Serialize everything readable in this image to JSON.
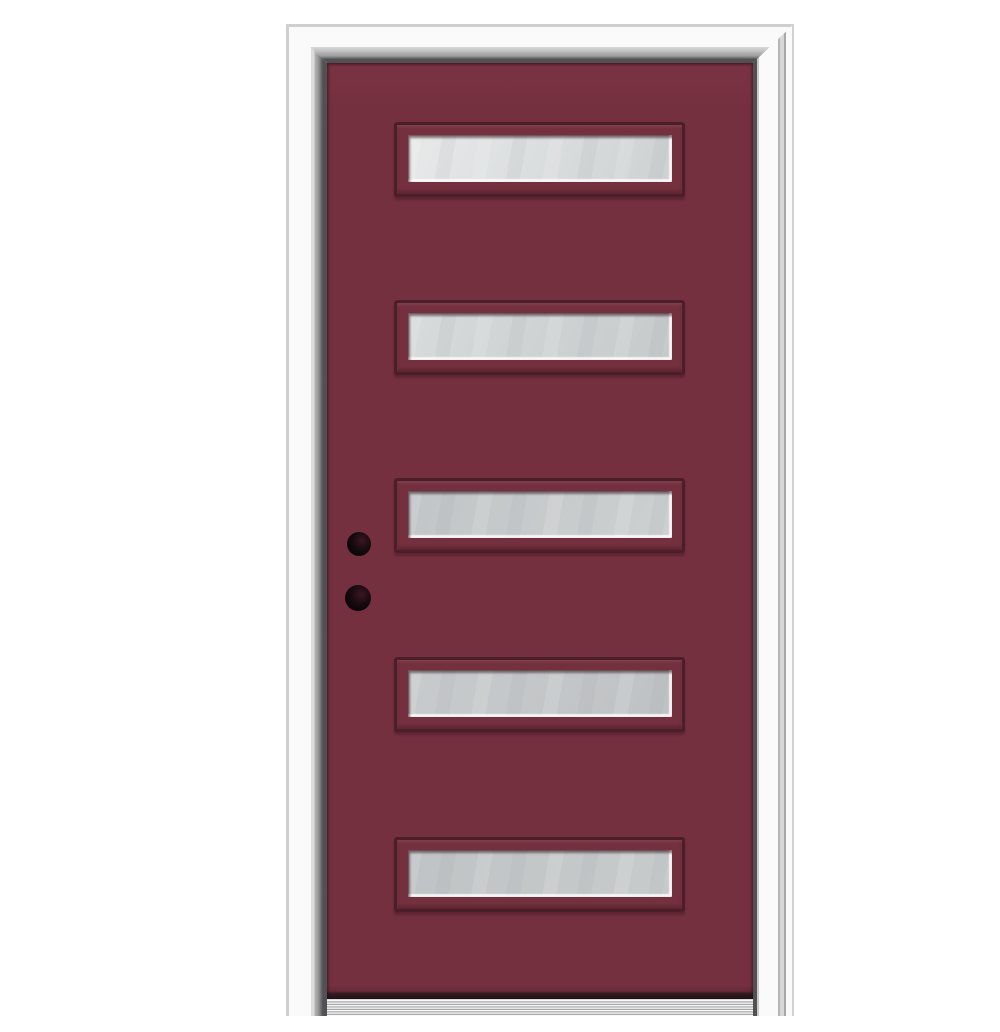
{
  "image": {
    "type": "product-photo",
    "subject": "Burgundy painted front entry door, right-hand inswing, with five horizontal frosted-glass lites, prehung in a white primed frame with an aluminum sill on a plain white background",
    "visible_text": "none"
  },
  "colors": {
    "background": "#FFFFFF",
    "door_paint": "#75303F",
    "door_paint_name": "burgundy",
    "molding_outline": "#4C1E2A",
    "slab_bottom_shadow": "#2E191F",
    "frame_white": "#FAFAFA",
    "frame_light_line": "#CFCFCF",
    "frame_jamb_dark": "#515153",
    "bore_hole_black": "#0B0608",
    "sill_silver_light": "#F8F8F8",
    "sill_silver_dark": "#8F8F91"
  },
  "door": {
    "lite_count": 5,
    "lite_style": "horizontal rectangular frosted glass with burgundy bevel molding",
    "lites": [
      {
        "id": 1,
        "glass_start": "#E8EAEA",
        "glass_end": "#CDD1D2"
      },
      {
        "id": 2,
        "glass_start": "#D8DBDC",
        "glass_end": "#C6CACB"
      },
      {
        "id": 3,
        "glass_start": "#C2C5C7",
        "glass_end": "#CDD0D1"
      },
      {
        "id": 4,
        "glass_start": "#C8CBCD",
        "glass_end": "#BFC2C4"
      },
      {
        "id": 5,
        "glass_start": "#C0C3C5",
        "glass_end": "#C8CBCC"
      }
    ],
    "hardware": {
      "bore_holes": [
        "deadbolt-bore-hole",
        "lockset-bore-hole"
      ],
      "handle_installed": "no"
    },
    "frame": "white primed brickmould casing, mitred corners",
    "threshold": "ribbed aluminum sill"
  }
}
